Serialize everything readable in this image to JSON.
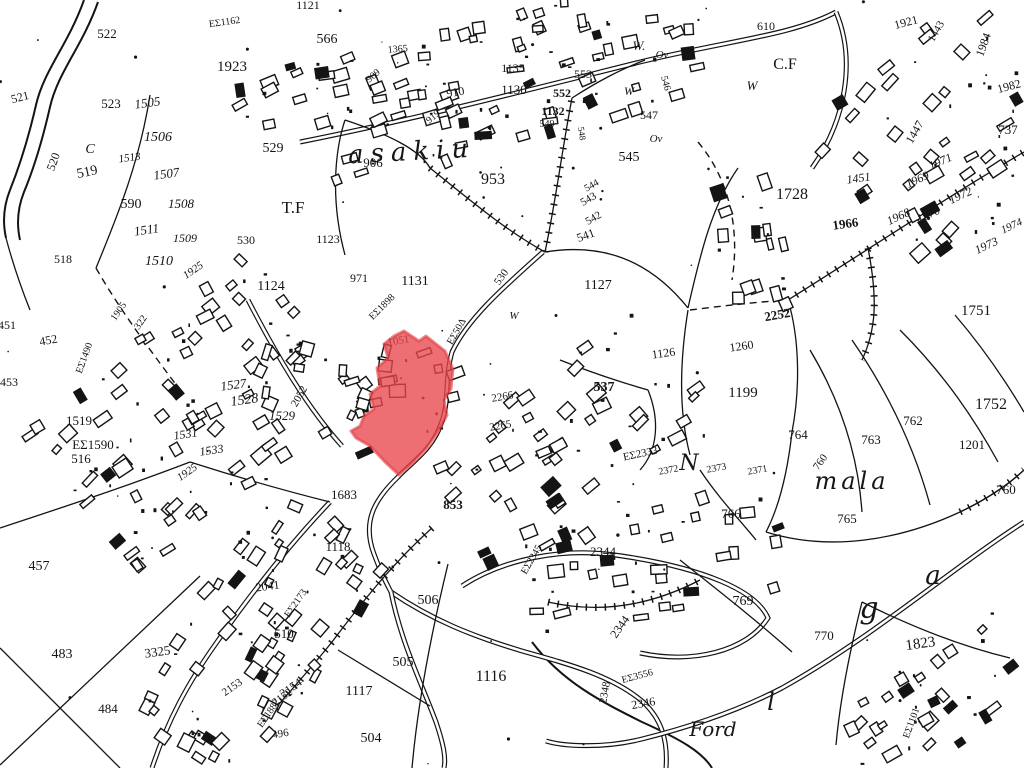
{
  "map": {
    "type": "cadastral-survey-map",
    "background": "#ffffff",
    "ink": "#141414",
    "highlight": {
      "name": "highlighted-parcel",
      "fill": "#e8474b",
      "stroke": "#dd3a40",
      "opacity": 0.78,
      "points": [
        [
          404,
          331
        ],
        [
          419,
          341
        ],
        [
          426,
          336
        ],
        [
          445,
          351
        ],
        [
          453,
          369
        ],
        [
          451,
          389
        ],
        [
          444,
          400
        ],
        [
          447,
          415
        ],
        [
          438,
          432
        ],
        [
          427,
          448
        ],
        [
          412,
          464
        ],
        [
          399,
          475
        ],
        [
          385,
          462
        ],
        [
          370,
          446
        ],
        [
          356,
          438
        ],
        [
          351,
          431
        ],
        [
          360,
          426
        ],
        [
          364,
          416
        ],
        [
          374,
          409
        ],
        [
          370,
          394
        ],
        [
          380,
          386
        ],
        [
          377,
          368
        ],
        [
          388,
          358
        ],
        [
          384,
          344
        ],
        [
          394,
          336
        ]
      ]
    },
    "place_names": [
      {
        "t": "asakiu",
        "x": 412,
        "y": 160,
        "s": 26,
        "sp": 7,
        "r": -3
      },
      {
        "t": "N",
        "x": 689,
        "y": 470,
        "s": 22
      },
      {
        "t": "mala",
        "x": 852,
        "y": 489,
        "s": 24,
        "sp": 4
      },
      {
        "t": "g",
        "x": 869,
        "y": 618,
        "s": 30
      },
      {
        "t": "a",
        "x": 933,
        "y": 584,
        "s": 26
      },
      {
        "t": "l",
        "x": 771,
        "y": 710,
        "s": 24
      },
      {
        "t": "Ford",
        "x": 713,
        "y": 736,
        "s": 20
      }
    ],
    "labels": [
      {
        "t": "522",
        "x": 107,
        "y": 38,
        "s": 13
      },
      {
        "t": "1923",
        "x": 232,
        "y": 71,
        "s": 15
      },
      {
        "t": "566",
        "x": 327,
        "y": 43,
        "s": 14
      },
      {
        "t": "ΕΣ1162",
        "x": 225,
        "y": 25,
        "s": 10,
        "r": -8
      },
      {
        "t": "1121",
        "x": 308,
        "y": 9,
        "s": 12
      },
      {
        "t": "521",
        "x": 21,
        "y": 101,
        "s": 12,
        "r": -15
      },
      {
        "t": "523",
        "x": 111,
        "y": 108,
        "s": 13
      },
      {
        "t": "1505",
        "x": 148,
        "y": 107,
        "s": 13,
        "r": -8,
        "i": 1
      },
      {
        "t": "1506",
        "x": 158,
        "y": 141,
        "s": 14,
        "i": 1
      },
      {
        "t": "1513",
        "x": 130,
        "y": 161,
        "s": 11,
        "r": -8,
        "i": 1
      },
      {
        "t": "1507",
        "x": 167,
        "y": 178,
        "s": 13,
        "r": -8,
        "i": 1
      },
      {
        "t": "1508",
        "x": 181,
        "y": 208,
        "s": 13,
        "i": 1
      },
      {
        "t": "1511",
        "x": 147,
        "y": 234,
        "s": 13,
        "r": -8,
        "i": 1
      },
      {
        "t": "1509",
        "x": 185,
        "y": 242,
        "s": 12,
        "i": 1
      },
      {
        "t": "520",
        "x": 57,
        "y": 163,
        "s": 12,
        "r": -70
      },
      {
        "t": "519",
        "x": 88,
        "y": 176,
        "s": 14,
        "r": -12
      },
      {
        "t": "590",
        "x": 131,
        "y": 208,
        "s": 14
      },
      {
        "t": "529",
        "x": 273,
        "y": 152,
        "s": 14
      },
      {
        "t": "T.F",
        "x": 293,
        "y": 213,
        "s": 17
      },
      {
        "t": "530",
        "x": 246,
        "y": 244,
        "s": 12
      },
      {
        "t": "1123",
        "x": 328,
        "y": 243,
        "s": 12
      },
      {
        "t": "1124",
        "x": 271,
        "y": 290,
        "s": 14
      },
      {
        "t": "C",
        "x": 90,
        "y": 153,
        "s": 14,
        "i": 1
      },
      {
        "t": "906",
        "x": 373,
        "y": 167,
        "s": 13
      },
      {
        "t": "909",
        "x": 375,
        "y": 78,
        "s": 10,
        "r": -40
      },
      {
        "t": "910",
        "x": 456,
        "y": 96,
        "s": 12,
        "r": -10
      },
      {
        "t": "919",
        "x": 435,
        "y": 119,
        "s": 10,
        "r": -40
      },
      {
        "t": "1365",
        "x": 398,
        "y": 52,
        "s": 10,
        "r": -5
      },
      {
        "t": "953",
        "x": 493,
        "y": 184,
        "s": 16
      },
      {
        "t": "1135",
        "x": 513,
        "y": 72,
        "s": 12
      },
      {
        "t": "1130",
        "x": 514,
        "y": 94,
        "s": 13
      },
      {
        "t": "553",
        "x": 583,
        "y": 78,
        "s": 12
      },
      {
        "t": "552",
        "x": 562,
        "y": 97,
        "s": 12,
        "b": 1
      },
      {
        "t": "1132",
        "x": 553,
        "y": 115,
        "s": 12,
        "b": 1
      },
      {
        "t": "549",
        "x": 547,
        "y": 127,
        "s": 10
      },
      {
        "t": "548",
        "x": 579,
        "y": 134,
        "s": 9,
        "r": 80
      },
      {
        "t": "547",
        "x": 649,
        "y": 119,
        "s": 12
      },
      {
        "t": "545",
        "x": 629,
        "y": 161,
        "s": 14
      },
      {
        "t": "546",
        "x": 663,
        "y": 84,
        "s": 10,
        "r": 75
      },
      {
        "t": "544",
        "x": 593,
        "y": 188,
        "s": 10,
        "r": -30
      },
      {
        "t": "543",
        "x": 590,
        "y": 202,
        "s": 11,
        "r": -30
      },
      {
        "t": "542",
        "x": 595,
        "y": 221,
        "s": 11,
        "r": -30
      },
      {
        "t": "541",
        "x": 587,
        "y": 239,
        "s": 12,
        "r": -20
      },
      {
        "t": "W.",
        "x": 639,
        "y": 50,
        "s": 13,
        "i": 1
      },
      {
        "t": "Ov",
        "x": 662,
        "y": 58,
        "s": 11,
        "i": 1
      },
      {
        "t": "W",
        "x": 629,
        "y": 95,
        "s": 12,
        "i": 1
      },
      {
        "t": "Ov",
        "x": 656,
        "y": 142,
        "s": 11,
        "i": 1
      },
      {
        "t": "610",
        "x": 766,
        "y": 30,
        "s": 12
      },
      {
        "t": "C.F",
        "x": 785,
        "y": 69,
        "s": 16
      },
      {
        "t": "W",
        "x": 752,
        "y": 90,
        "s": 13,
        "i": 1
      },
      {
        "t": "1728",
        "x": 792,
        "y": 199,
        "s": 16
      },
      {
        "t": "1451",
        "x": 859,
        "y": 182,
        "s": 12,
        "r": -8,
        "i": 1
      },
      {
        "t": "1447",
        "x": 918,
        "y": 134,
        "s": 12,
        "r": -60
      },
      {
        "t": "1921",
        "x": 907,
        "y": 26,
        "s": 12,
        "r": -15
      },
      {
        "t": "1443",
        "x": 939,
        "y": 33,
        "s": 11,
        "r": -60
      },
      {
        "t": "1984",
        "x": 987,
        "y": 46,
        "s": 12,
        "r": -70
      },
      {
        "t": "1982",
        "x": 1010,
        "y": 90,
        "s": 12,
        "r": -15
      },
      {
        "t": "737",
        "x": 1008,
        "y": 134,
        "s": 13
      },
      {
        "t": "1966",
        "x": 846,
        "y": 228,
        "s": 13,
        "b": 1,
        "r": -8
      },
      {
        "t": "1969",
        "x": 919,
        "y": 183,
        "s": 12,
        "r": -25,
        "i": 1
      },
      {
        "t": "1971",
        "x": 942,
        "y": 165,
        "s": 12,
        "r": -25,
        "i": 1
      },
      {
        "t": "1972",
        "x": 962,
        "y": 199,
        "s": 12,
        "r": -25,
        "i": 1
      },
      {
        "t": "1970",
        "x": 930,
        "y": 218,
        "s": 12,
        "r": -25,
        "i": 1
      },
      {
        "t": "1968",
        "x": 900,
        "y": 220,
        "s": 12,
        "r": -25,
        "i": 1
      },
      {
        "t": "1973",
        "x": 988,
        "y": 249,
        "s": 12,
        "r": -25,
        "i": 1
      },
      {
        "t": "1974",
        "x": 1013,
        "y": 229,
        "s": 11,
        "r": -25,
        "i": 1
      },
      {
        "t": "518",
        "x": 63,
        "y": 263,
        "s": 12
      },
      {
        "t": "1510",
        "x": 159,
        "y": 265,
        "s": 14,
        "i": 1
      },
      {
        "t": "1925",
        "x": 195,
        "y": 273,
        "s": 11,
        "r": -35,
        "i": 1
      },
      {
        "t": "451",
        "x": 7,
        "y": 329,
        "s": 12
      },
      {
        "t": "452",
        "x": 49,
        "y": 344,
        "s": 12,
        "r": -10
      },
      {
        "t": "453",
        "x": 9,
        "y": 386,
        "s": 12
      },
      {
        "t": "ΕΣ1490",
        "x": 87,
        "y": 359,
        "s": 10,
        "r": -70
      },
      {
        "t": "1905",
        "x": 121,
        "y": 313,
        "s": 10,
        "r": -55
      },
      {
        "t": "322",
        "x": 143,
        "y": 324,
        "s": 10,
        "r": -55
      },
      {
        "t": "1519",
        "x": 79,
        "y": 425,
        "s": 13
      },
      {
        "t": "ΕΣ1590",
        "x": 93,
        "y": 449,
        "s": 13
      },
      {
        "t": "516",
        "x": 81,
        "y": 463,
        "s": 13
      },
      {
        "t": "1527",
        "x": 234,
        "y": 389,
        "s": 13,
        "r": -8,
        "i": 1
      },
      {
        "t": "1528",
        "x": 245,
        "y": 404,
        "s": 14,
        "r": -8,
        "i": 1
      },
      {
        "t": "1529",
        "x": 282,
        "y": 420,
        "s": 13,
        "i": 1
      },
      {
        "t": "2052",
        "x": 302,
        "y": 398,
        "s": 11,
        "r": -60
      },
      {
        "t": "1531",
        "x": 186,
        "y": 438,
        "s": 12,
        "r": -8,
        "i": 1
      },
      {
        "t": "1533",
        "x": 212,
        "y": 454,
        "s": 12,
        "r": -8,
        "i": 1
      },
      {
        "t": "1925",
        "x": 189,
        "y": 475,
        "s": 11,
        "r": -35,
        "i": 1
      },
      {
        "t": "457",
        "x": 39,
        "y": 570,
        "s": 14
      },
      {
        "t": "483",
        "x": 62,
        "y": 658,
        "s": 14
      },
      {
        "t": "484",
        "x": 108,
        "y": 713,
        "s": 13
      },
      {
        "t": "3325",
        "x": 158,
        "y": 656,
        "s": 13,
        "r": -8
      },
      {
        "t": "971",
        "x": 359,
        "y": 282,
        "s": 12
      },
      {
        "t": "1131",
        "x": 415,
        "y": 285,
        "s": 14
      },
      {
        "t": "ΕΣ1898",
        "x": 384,
        "y": 309,
        "s": 10,
        "r": -45
      },
      {
        "t": "1051",
        "x": 399,
        "y": 344,
        "s": 11,
        "r": -10
      },
      {
        "t": "ΕΣ50Δ",
        "x": 459,
        "y": 333,
        "s": 10,
        "r": -60
      },
      {
        "t": "530",
        "x": 504,
        "y": 279,
        "s": 11,
        "r": -55
      },
      {
        "t": "W",
        "x": 514,
        "y": 319,
        "s": 11,
        "i": 1
      },
      {
        "t": "1127",
        "x": 598,
        "y": 289,
        "s": 14
      },
      {
        "t": "1126",
        "x": 664,
        "y": 357,
        "s": 12,
        "r": -8
      },
      {
        "t": "537",
        "x": 604,
        "y": 391,
        "s": 14,
        "b": 1
      },
      {
        "t": "2266",
        "x": 503,
        "y": 400,
        "s": 11,
        "r": -10
      },
      {
        "t": "2265",
        "x": 501,
        "y": 429,
        "s": 11,
        "r": -10
      },
      {
        "t": "853",
        "x": 453,
        "y": 509,
        "s": 13,
        "b": 1
      },
      {
        "t": "1683",
        "x": 344,
        "y": 499,
        "s": 13
      },
      {
        "t": "1118",
        "x": 338,
        "y": 551,
        "s": 13
      },
      {
        "t": "2041",
        "x": 268,
        "y": 590,
        "s": 12,
        "r": -8
      },
      {
        "t": "ΕΣ2173",
        "x": 298,
        "y": 605,
        "s": 10,
        "r": -55
      },
      {
        "t": "510",
        "x": 284,
        "y": 638,
        "s": 13
      },
      {
        "t": "506",
        "x": 428,
        "y": 604,
        "s": 14
      },
      {
        "t": "505",
        "x": 403,
        "y": 666,
        "s": 14
      },
      {
        "t": "1117",
        "x": 359,
        "y": 695,
        "s": 14
      },
      {
        "t": "504",
        "x": 371,
        "y": 742,
        "s": 14
      },
      {
        "t": "1116",
        "x": 491,
        "y": 681,
        "s": 16
      },
      {
        "t": "2153",
        "x": 234,
        "y": 690,
        "s": 11,
        "r": -35
      },
      {
        "t": "2154",
        "x": 293,
        "y": 691,
        "s": 12,
        "r": -35
      },
      {
        "t": "2152",
        "x": 284,
        "y": 700,
        "s": 11,
        "r": -35
      },
      {
        "t": "ΕΣ1882",
        "x": 271,
        "y": 715,
        "s": 10,
        "r": -55
      },
      {
        "t": "496",
        "x": 281,
        "y": 737,
        "s": 11,
        "r": -10
      },
      {
        "t": "2344",
        "x": 603,
        "y": 556,
        "s": 13
      },
      {
        "t": "ΕΣ2345",
        "x": 534,
        "y": 561,
        "s": 10,
        "r": -60
      },
      {
        "t": "2344",
        "x": 623,
        "y": 629,
        "s": 12,
        "r": -55
      },
      {
        "t": "2348",
        "x": 608,
        "y": 693,
        "s": 11,
        "r": -80
      },
      {
        "t": "ΕΣ3556",
        "x": 638,
        "y": 679,
        "s": 10,
        "r": -15
      },
      {
        "t": "2346",
        "x": 644,
        "y": 707,
        "s": 12,
        "r": -10
      },
      {
        "t": "2252",
        "x": 778,
        "y": 319,
        "s": 13,
        "b": 1,
        "r": -10
      },
      {
        "t": "1260",
        "x": 742,
        "y": 350,
        "s": 12,
        "r": -8
      },
      {
        "t": "1751",
        "x": 976,
        "y": 315,
        "s": 15
      },
      {
        "t": "1752",
        "x": 991,
        "y": 409,
        "s": 16
      },
      {
        "t": "1199",
        "x": 743,
        "y": 397,
        "s": 15
      },
      {
        "t": "764",
        "x": 798,
        "y": 439,
        "s": 13
      },
      {
        "t": "763",
        "x": 871,
        "y": 444,
        "s": 13
      },
      {
        "t": "762",
        "x": 913,
        "y": 425,
        "s": 13
      },
      {
        "t": "1201",
        "x": 972,
        "y": 449,
        "s": 13
      },
      {
        "t": "760",
        "x": 823,
        "y": 464,
        "s": 11,
        "r": -55
      },
      {
        "t": "760",
        "x": 1006,
        "y": 494,
        "s": 13
      },
      {
        "t": "765",
        "x": 847,
        "y": 523,
        "s": 13
      },
      {
        "t": "766",
        "x": 731,
        "y": 518,
        "s": 13
      },
      {
        "t": "2372",
        "x": 669,
        "y": 473,
        "s": 10,
        "r": -10
      },
      {
        "t": "2373",
        "x": 717,
        "y": 471,
        "s": 10,
        "r": -10
      },
      {
        "t": "2371",
        "x": 758,
        "y": 473,
        "s": 10,
        "r": -10
      },
      {
        "t": "ΕΣ2333",
        "x": 641,
        "y": 457,
        "s": 11,
        "r": -12
      },
      {
        "t": "769",
        "x": 743,
        "y": 605,
        "s": 14
      },
      {
        "t": "770",
        "x": 824,
        "y": 640,
        "s": 13
      },
      {
        "t": "1823",
        "x": 921,
        "y": 648,
        "s": 15,
        "r": -8
      },
      {
        "t": "ΕΣ1101",
        "x": 914,
        "y": 724,
        "s": 10,
        "r": -70
      }
    ]
  }
}
